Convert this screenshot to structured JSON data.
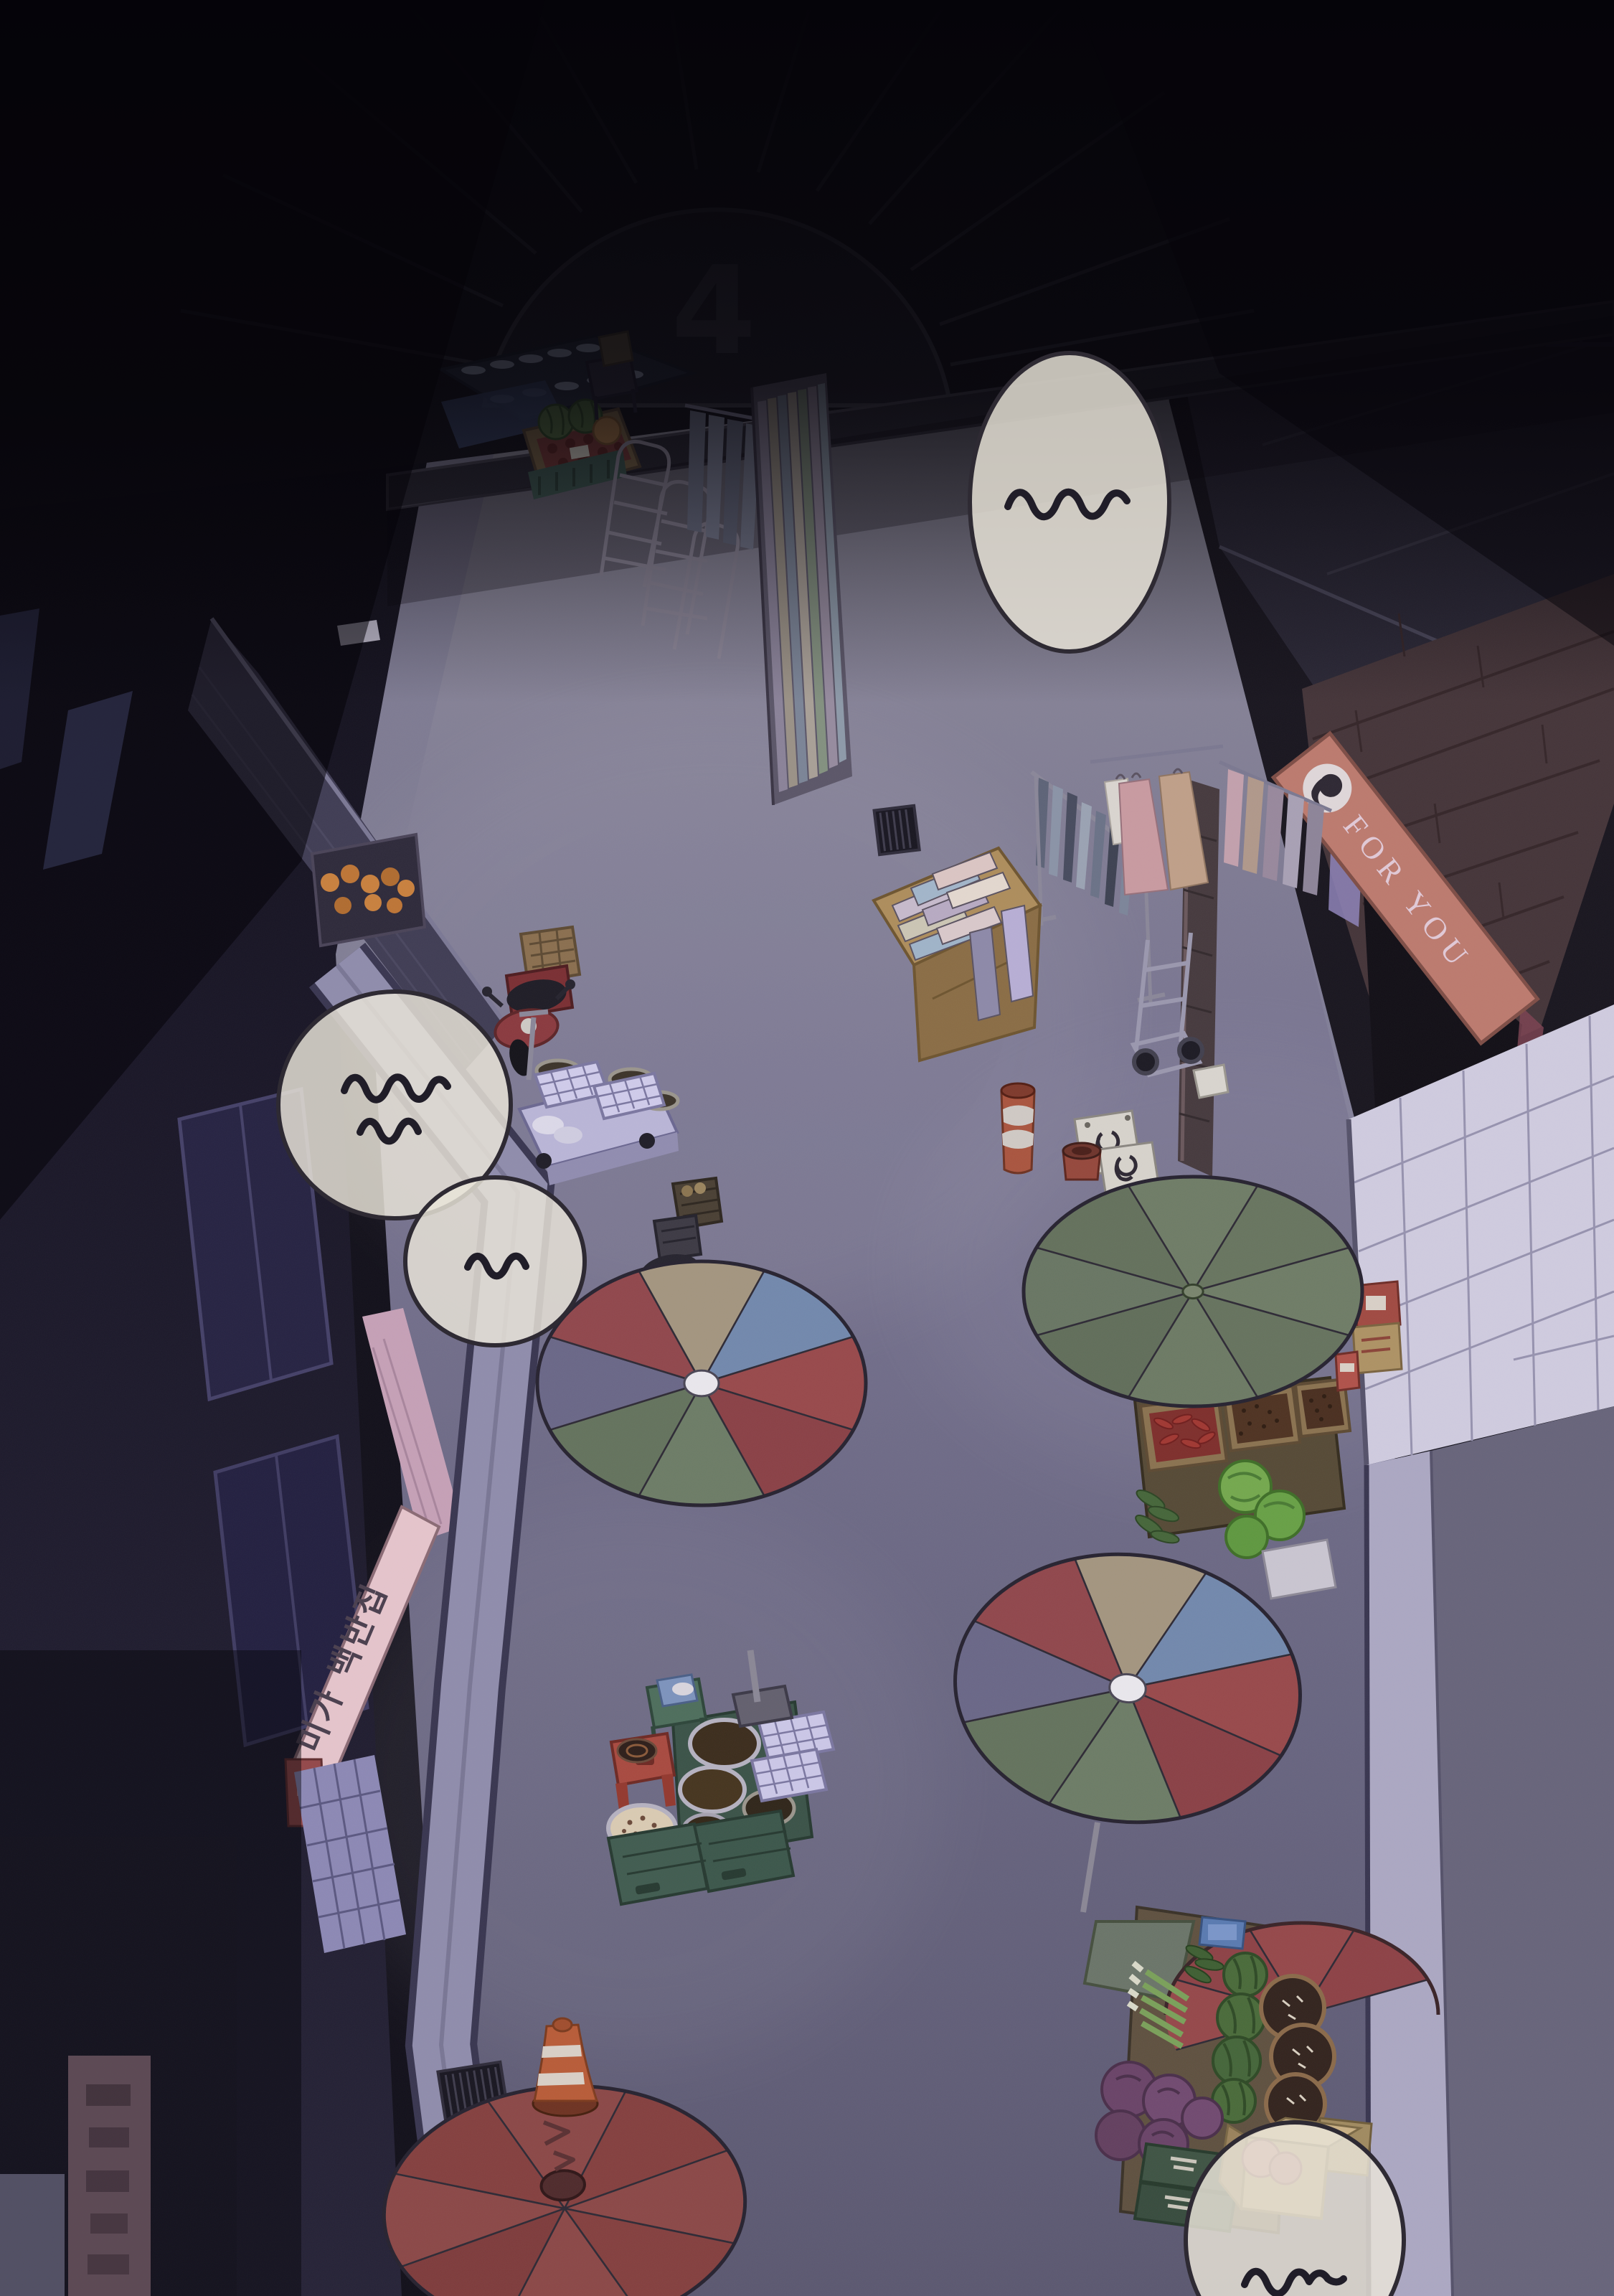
{
  "panel": {
    "gate_number": "4",
    "boutique_sign": "FOR YOU",
    "restaurant_sign": "미가 백반집",
    "speech_bubbles": [
      {
        "id": "top-right",
        "mark": "~~~"
      },
      {
        "id": "left-upper",
        "mark": "~~~ ~~"
      },
      {
        "id": "left-lower",
        "mark": "~~"
      },
      {
        "id": "bottom-right",
        "mark": "~~~"
      }
    ],
    "palette": {
      "night_black": "#0b0a10",
      "street_grey": "#6e6b82",
      "street_light": "#8f8c9a",
      "curb_lilac": "#8f8cab",
      "tile_white": "#cfcbde",
      "brick_brown": "#453539",
      "sign_salmon": "#bc7a6e",
      "sign_letters": "#e0c9d6",
      "restaurant_sign_pink": "#e4c4cb",
      "umbrella_green": "#6f7c66",
      "umbrella_red": "#98494b",
      "umbrella_blue": "#7288ac",
      "umbrella_tan": "#a3957f",
      "umbrella_slate": "#6a6787",
      "bubble_cream": "#e9e5d8",
      "cone_orange": "#b85c38",
      "cabbage_green": "#74a84e",
      "cabbage_purple": "#6a4468"
    },
    "objects": [
      "market-arcade-gate",
      "fan-awning",
      "dish-shelf",
      "produce-stall",
      "watermelon-crate",
      "arch-rack",
      "fabric-roll-wall",
      "clothes-rack",
      "scarf-rail",
      "dress-rack",
      "fabric-table",
      "hand-truck",
      "bollard",
      "for-you-boutique",
      "brick-wall",
      "tiled-plaza",
      "orange-fruit-shelf",
      "scooter-red",
      "scooter-black",
      "flatbed-cart",
      "steamer-trays",
      "red-barrel",
      "street-drain",
      "umbrella-green",
      "umbrella-multicolor-front",
      "umbrella-multicolor-rear",
      "umbrella-red-bottom",
      "umbrella-red-corner",
      "food-stall-bowls",
      "red-stool",
      "green-stool",
      "chili-box",
      "jujube-boxes",
      "cabbages",
      "cucumbers",
      "traffic-cone",
      "watermelon-stand",
      "green-onion-bundle",
      "purple-cabbages",
      "cardboard-boxes",
      "produce-crates",
      "toppled-signboard",
      "logo-signboards",
      "restaurant-awning",
      "tile-floor",
      "korean-banner",
      "snore-bubbles"
    ]
  }
}
